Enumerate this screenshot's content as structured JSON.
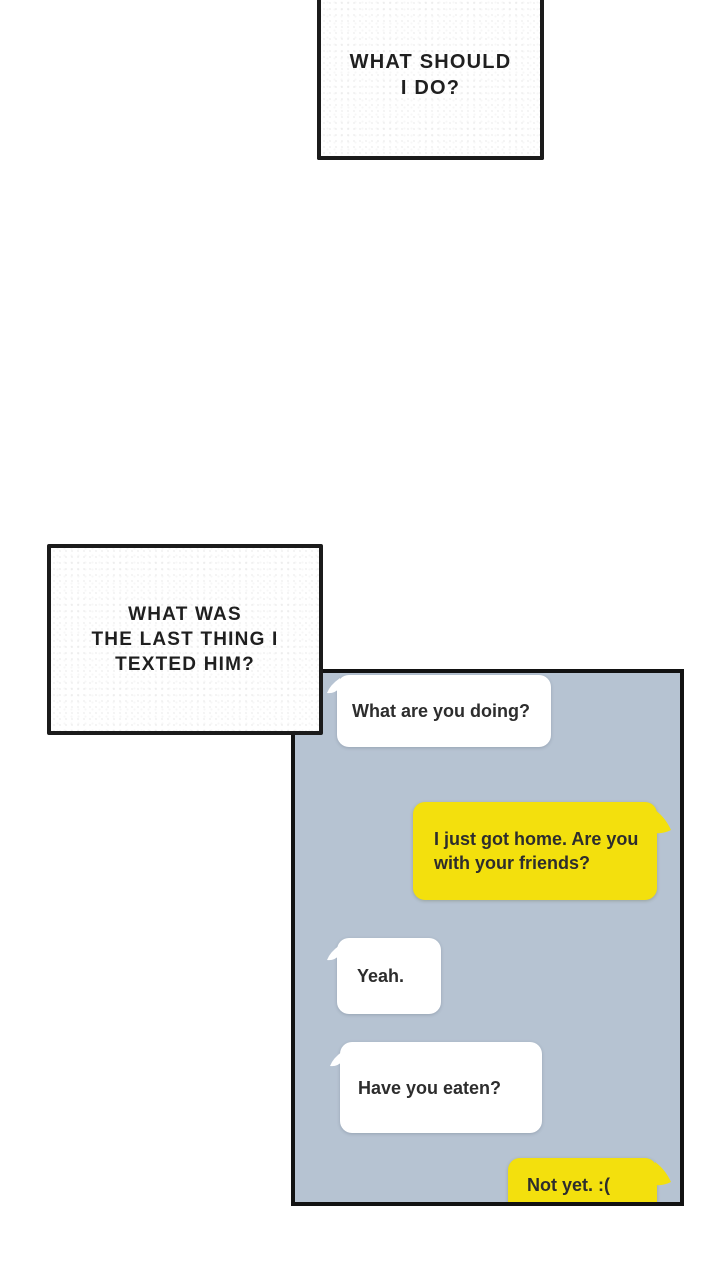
{
  "panels": {
    "thought_box_1": {
      "lines": [
        "WHAT SHOULD",
        "I DO?"
      ],
      "full_text": "WHAT SHOULD I DO?"
    },
    "thought_box_2": {
      "lines": [
        "WHAT WAS",
        "THE LAST THING I",
        "TEXTED HIM?"
      ],
      "full_text": "WHAT WAS THE LAST THING I TEXTED HIM?"
    }
  },
  "chat": {
    "messages": [
      {
        "side": "received",
        "text": "What are you doing?"
      },
      {
        "side": "sent",
        "text": "I just got home. Are you with your friends?"
      },
      {
        "side": "received",
        "text": "Yeah."
      },
      {
        "side": "received",
        "text": "Have you eaten?"
      },
      {
        "side": "sent",
        "text": "Not yet. :("
      }
    ]
  },
  "colors": {
    "page_background": "#ffffff",
    "chat_background": "#b6c3d2",
    "bubble_received": "#ffffff",
    "bubble_sent": "#f3e00d",
    "panel_border": "#121212",
    "text": "#2d2d2d"
  }
}
